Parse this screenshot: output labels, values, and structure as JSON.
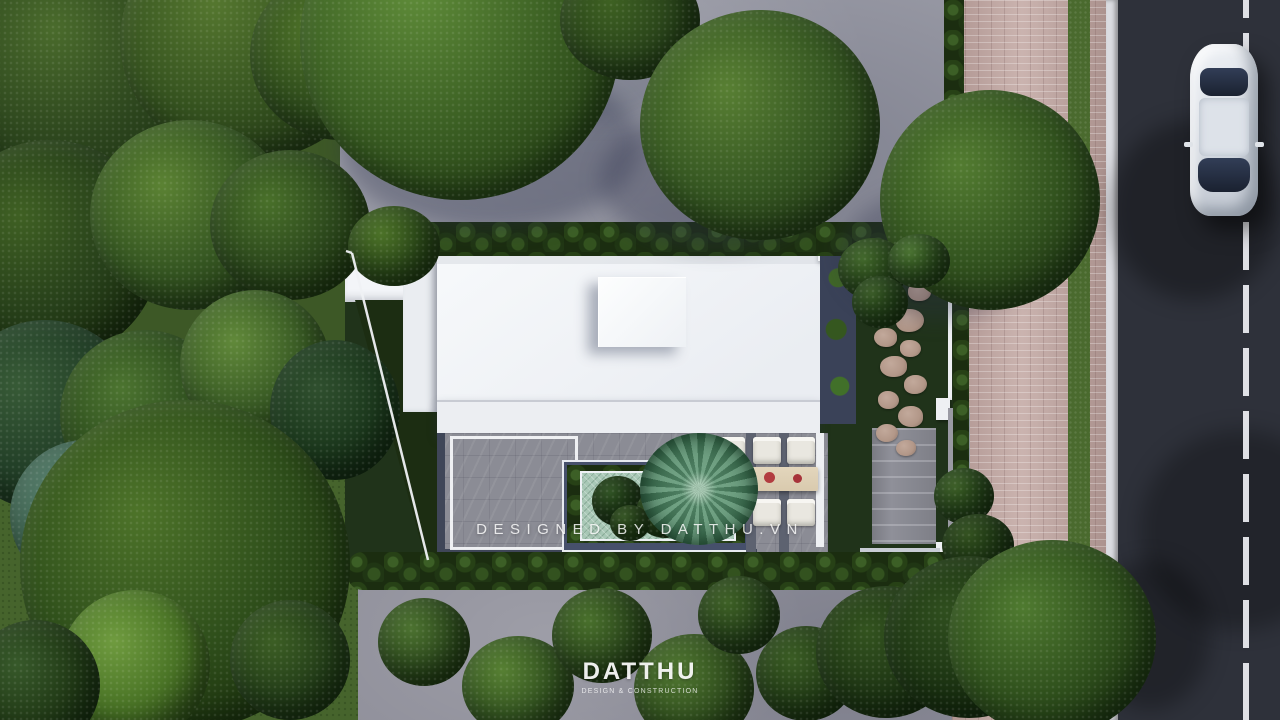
{
  "watermark": {
    "text": "DESIGNED BY DATTHU.VN"
  },
  "brand": {
    "name": "DATTHU",
    "tagline": "DESIGN & CONSTRUCTION"
  },
  "palette": {
    "lawn": "#3d5826",
    "lawn_bright": "#46642c",
    "plot_lawn": "#20331a",
    "concrete": "#9a9ba6",
    "concrete_lower": "#90909b",
    "roof": "#f3f5f8",
    "roof_band": "#eceef2",
    "road": "#2e313a",
    "curb": "#dbdce1",
    "paver_pink": "#c2a7a2",
    "grass_strip": "#4a6a2e",
    "hedge": "#1b2d10",
    "court_floor": "#8b8c95",
    "court_edge": "#3f4658",
    "mosaic": "#a8c8b6",
    "table_wood": "#d9caae",
    "chair": "#e9e7e0",
    "flower_red": "#a7333a",
    "stone": "#b29788",
    "walk_paver": "#8f9099",
    "planter": "#3a4258",
    "wall_white": "#eef0f3",
    "car_body": "#c9cfd8",
    "car_glass": "#1a2130",
    "palm_green": "#53836a"
  }
}
